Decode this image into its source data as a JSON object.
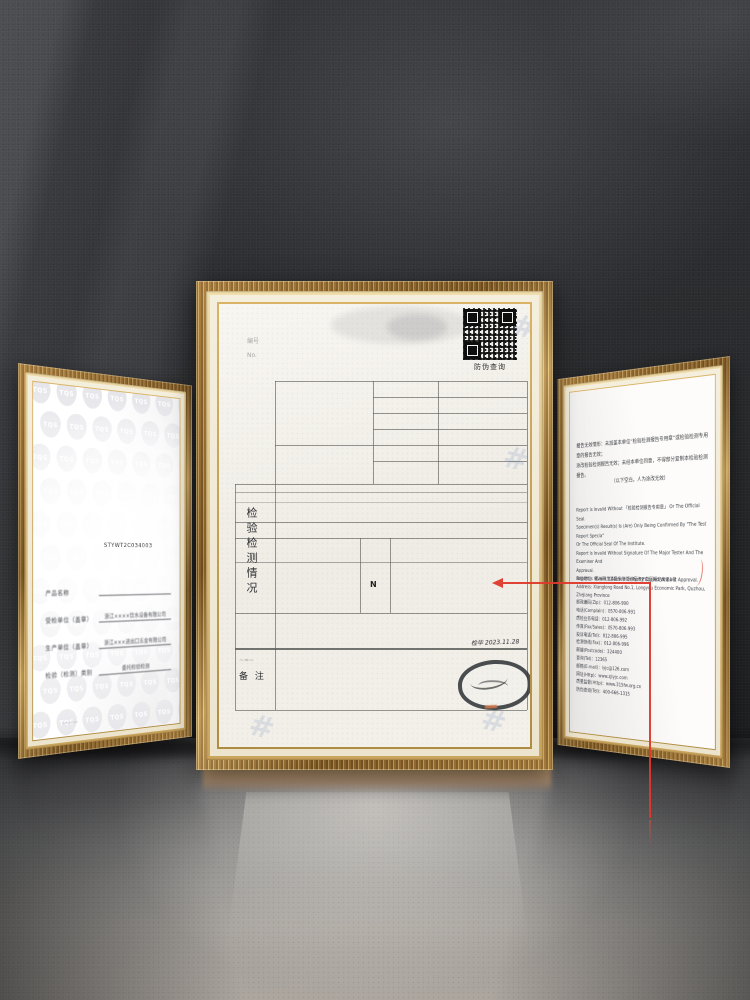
{
  "scene": {
    "description": "Three gold ornate frames with inspection certificates standing on a glossy floor against a dark textured wall",
    "accent_red": "#de392b",
    "frame_gold": "#c49a55",
    "mat_cream": "#f4eedd"
  },
  "center_certificate": {
    "qr_caption": "防伪查询",
    "section_label_vertical": "检验检测情况",
    "remark_label": "备 注",
    "result_mark": "N",
    "handwritten_note": "检毕 2023.11.28",
    "faint_note_1": "编号",
    "faint_note_2": "No.",
    "remark_scribble": "~≈~"
  },
  "left_certificate": {
    "report_no": "STYWT2C034003",
    "watermark_text": "TQS",
    "watermark_rows": 11,
    "watermark_cols": 7,
    "fields": [
      {
        "label": "产品名称",
        "value": ""
      },
      {
        "label": "受检单位（盖章）",
        "value": "浙江××××饮水设备有限公司"
      },
      {
        "label": "生产单位（盖章）",
        "value": "浙江×××进出口五金有限公司"
      },
      {
        "label": "检验（检测）类别",
        "value": "委托检验检测"
      }
    ],
    "signature_scribble": "﹏﹏"
  },
  "right_certificate": {
    "notes_cn": [
      "报告无效情形：未加盖本单位“检验检测报告专用章”或检验检测专用章的报告无效；",
      "涂改检验检测报告无效；未经本单位同意，不得部分复制本检验检测报告。"
    ],
    "note_cn_center": "（以下空白，人为涂改无效）",
    "notes_en": [
      "Report Is Invalid Without 「检验检测报告专用章」 Or The Official Seal.",
      "Specimen(s) Result(s) Is (Are) Only Being Confirmed By \"The Test Report Specia\"",
      "Or The Official Seal Of The Institute.",
      "Report Is Invalid Without Signature Of The Major Tester And The Examiner And",
      "Approval.",
      "Report Is Invalid If Altered Or Partly Copied Without Approval."
    ],
    "contact_lines": [
      "单位地址：衢州市龙游县东华街道经济开发区翔龙大道1号",
      "Address: Xianglong Road No.1, Longyou Economic Park, Quzhou, Zhejiang Province",
      "邮政编码(Zip)：012-806-990",
      "电话(Complain)：0570-806-991",
      "质检业务电话：012-806-992",
      "传真(Fax/Sales)：0570-806-993",
      "投诉电话(Tel)：012-806-995",
      "检测快线(Fax)：012-806-996",
      "邮编(Postcode)：324400",
      "查询(Tel)：12365",
      "邮箱(E-mail)：lyjc@126.com",
      "网址(Http)：www.zjlyjc.com",
      "质量监督(Http)：www.315fw.org.cn",
      "防伪查询(Tel)：400-666-1315"
    ]
  }
}
